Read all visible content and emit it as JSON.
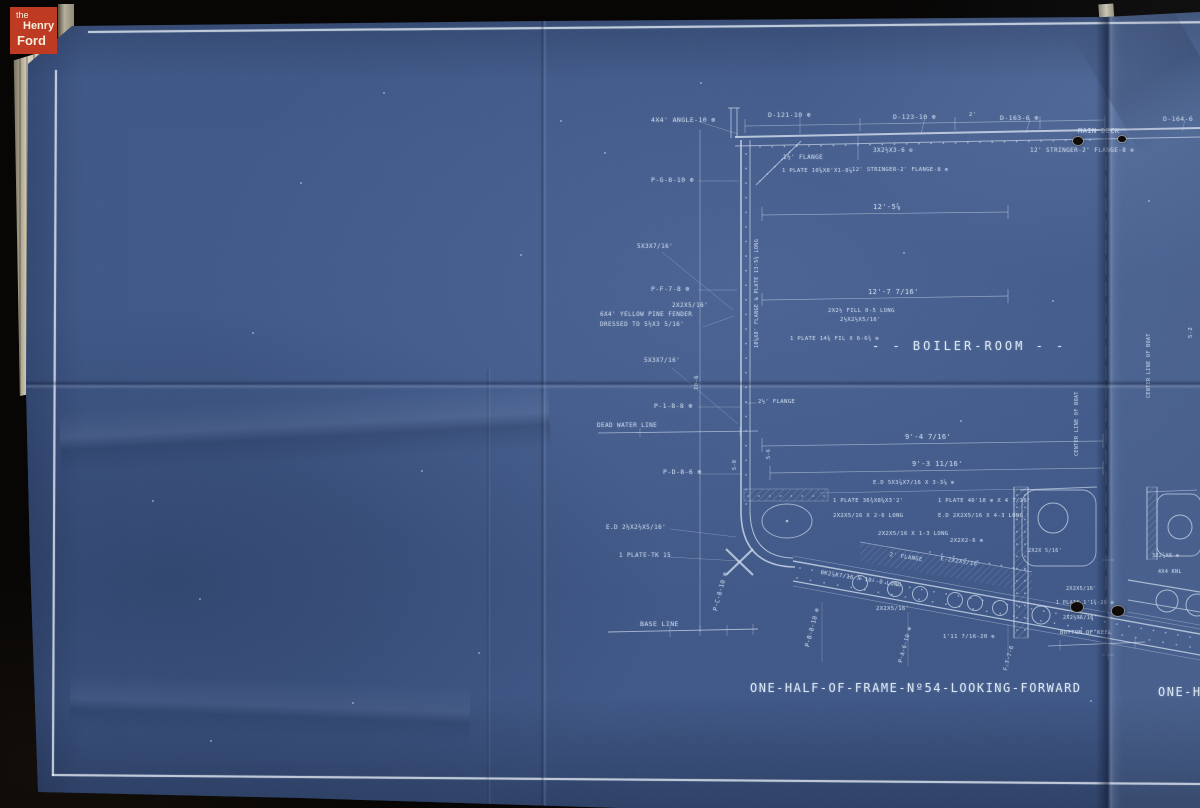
{
  "colors": {
    "paper_blue": "#3e5787",
    "line": "#cdd9ec",
    "logo_red": "#bf3a23",
    "backdrop": "#070605",
    "cream": "#d8d2bd"
  },
  "logo": {
    "prefix": "the",
    "top": "Henry",
    "bottom": "Ford"
  },
  "blueprint": {
    "room_label": "- - BOILER-ROOM - -",
    "caption": "ONE-HALF-OF-FRAME-Nº54-LOOKING-FORWARD",
    "caption_partial": "ONE-HA",
    "annotations": [
      {
        "t": "4X4' ANGLE-10 ⊕",
        "x": 651,
        "y": 116
      },
      {
        "t": "D-121-10 ⊕",
        "x": 768,
        "y": 111
      },
      {
        "t": "D-123-10 ⊕",
        "x": 893,
        "y": 113
      },
      {
        "t": "D-163-6 ⊕",
        "x": 1000,
        "y": 114
      },
      {
        "t": "D-164-6",
        "x": 1163,
        "y": 115
      },
      {
        "t": "MAIN DECK",
        "x": 1078,
        "y": 127,
        "s": 7
      },
      {
        "t": "12' STRINGER-2' FLANGE-8 ⊕",
        "x": 1030,
        "y": 147,
        "s": 6
      },
      {
        "t": "3X2½X3-6 ⊕",
        "x": 873,
        "y": 147,
        "s": 6
      },
      {
        "t": "1½' FLANGE",
        "x": 783,
        "y": 154,
        "s": 6
      },
      {
        "t": "1 PLATE 10⅝X8'X1-8⅞",
        "x": 782,
        "y": 168,
        "s": 5.5
      },
      {
        "t": "12' STRINGER-2' FLANGE-8 ⊕",
        "x": 852,
        "y": 167,
        "s": 5.5
      },
      {
        "t": "P-G-8-10 ⊕",
        "x": 651,
        "y": 176
      },
      {
        "t": "12'-5⅞",
        "x": 873,
        "y": 203,
        "s": 7
      },
      {
        "t": "5X3X7/16'",
        "x": 637,
        "y": 243,
        "s": 6
      },
      {
        "t": "P-F-7-8 ⊕",
        "x": 651,
        "y": 285
      },
      {
        "t": "2X2X5/16'",
        "x": 672,
        "y": 302,
        "s": 6
      },
      {
        "t": "12'-7 7/16'",
        "x": 868,
        "y": 288,
        "s": 7
      },
      {
        "t": "6X4' YELLOW PINE FENDER",
        "x": 600,
        "y": 311,
        "s": 6
      },
      {
        "t": "DRESSED TO 5½X3 5/16'",
        "x": 600,
        "y": 321,
        "s": 6
      },
      {
        "t": "2X2½ FILL 0-5 LONG",
        "x": 828,
        "y": 308,
        "s": 5.5
      },
      {
        "t": "2½X2½X5/16'",
        "x": 840,
        "y": 317,
        "s": 5.5
      },
      {
        "t": "1 PLATE 14⅜ FIL X 6-6¾ ⊕",
        "x": 790,
        "y": 336,
        "s": 5.5
      },
      {
        "t": "5X3X7/16'",
        "x": 644,
        "y": 357,
        "s": 6
      },
      {
        "t": "P-1-8-8 ⊕",
        "x": 654,
        "y": 402
      },
      {
        "t": "2½' FLANGE",
        "x": 758,
        "y": 399,
        "s": 5.5
      },
      {
        "t": "DEAD WATER LINE",
        "x": 597,
        "y": 422,
        "s": 6
      },
      {
        "t": "9'-4 7/16'",
        "x": 905,
        "y": 433,
        "s": 7
      },
      {
        "t": "9'-3 11/16'",
        "x": 912,
        "y": 460,
        "s": 7
      },
      {
        "t": "E.D 5X3⅞X7/16 X 3-3⅞ ⊕",
        "x": 873,
        "y": 480,
        "s": 5.5
      },
      {
        "t": "P-D-8-6 ⊕",
        "x": 663,
        "y": 468
      },
      {
        "t": "1 PLATE 36¾X8⅝X3'2'",
        "x": 833,
        "y": 498,
        "s": 5.5
      },
      {
        "t": "1 PLATE 46'18 ⊕ X 4 7/16'",
        "x": 938,
        "y": 498,
        "s": 5.5
      },
      {
        "t": "2X2X5/16 X 2-6 LONG",
        "x": 833,
        "y": 513,
        "s": 5.5
      },
      {
        "t": "E.D 2X2X5/16 X 4-3 LONG",
        "x": 938,
        "y": 513,
        "s": 5.5
      },
      {
        "t": "E.D 2½X2½X5/16'",
        "x": 606,
        "y": 524,
        "s": 6
      },
      {
        "t": "2X2X5/16 X 1-3 LONG",
        "x": 878,
        "y": 531,
        "s": 5.5
      },
      {
        "t": "2X2X2-6 ⊕",
        "x": 950,
        "y": 538,
        "s": 5.5
      },
      {
        "t": "1 PLATE-TK 15",
        "x": 619,
        "y": 552,
        "s": 6
      },
      {
        "t": "2' FLANGE",
        "x": 890,
        "y": 552,
        "r": 9,
        "s": 5.5
      },
      {
        "t": "E-2X2X5/16'",
        "x": 941,
        "y": 556,
        "r": 9,
        "s": 5.5
      },
      {
        "t": "6X2⅞X7/16 X 10'-0 LONG",
        "x": 821,
        "y": 570,
        "r": 9,
        "s": 5.5
      },
      {
        "t": "2X2X5/16'",
        "x": 876,
        "y": 606,
        "s": 5.5
      },
      {
        "t": "P-C-8-10 ⊕",
        "x": 712,
        "y": 610,
        "r": -75,
        "s": 6
      },
      {
        "t": "BASE LINE",
        "x": 640,
        "y": 620,
        "s": 6.5
      },
      {
        "t": "P-B-8-10 ⊕",
        "x": 804,
        "y": 646,
        "r": -75,
        "s": 6
      },
      {
        "t": "P-A-6-10 ⊕",
        "x": 898,
        "y": 662,
        "r": -75,
        "s": 5.5
      },
      {
        "t": "F-T-7-6",
        "x": 1003,
        "y": 670,
        "r": -75,
        "s": 5.5
      },
      {
        "t": "1'11 7/16-20 ⊕",
        "x": 943,
        "y": 634,
        "s": 5.5
      },
      {
        "t": "2X2X 5/16'",
        "x": 1028,
        "y": 548,
        "s": 5
      },
      {
        "t": "3X2⅞X6 ⊕",
        "x": 1152,
        "y": 553,
        "s": 5
      },
      {
        "t": "4X4 KNL",
        "x": 1158,
        "y": 569,
        "s": 5
      },
      {
        "t": "2X2X5/16'",
        "x": 1066,
        "y": 586,
        "s": 5
      },
      {
        "t": "1 PLATE 1'1¾-20 ⊕",
        "x": 1056,
        "y": 600,
        "s": 5
      },
      {
        "t": "2X2½X5/16'",
        "x": 1063,
        "y": 615,
        "s": 5
      },
      {
        "t": "BOTTOM OF KEEL",
        "x": 1060,
        "y": 630,
        "s": 5.5
      },
      {
        "t": "CENTER LINE OF BOAT",
        "x": 1146,
        "y": 398,
        "r": -90,
        "s": 5
      },
      {
        "t": "CENTER LINE OF BOAT",
        "x": 1074,
        "y": 456,
        "r": -90,
        "s": 5
      },
      {
        "t": "10⅝X8' FLANGE & PLATE 13-5¾ LONG",
        "x": 754,
        "y": 348,
        "r": -90,
        "s": 5
      },
      {
        "t": "10-6",
        "x": 694,
        "y": 390,
        "r": -90,
        "s": 5.5
      },
      {
        "t": "5-6",
        "x": 766,
        "y": 459,
        "r": -90,
        "s": 5
      },
      {
        "t": "5-0",
        "x": 732,
        "y": 470,
        "r": -90,
        "s": 5
      },
      {
        "t": "5-2",
        "x": 1188,
        "y": 338,
        "r": -90,
        "s": 5.5
      },
      {
        "t": "2'",
        "x": 969,
        "y": 112,
        "s": 5.5
      }
    ],
    "holes": [
      [
        1078,
        142,
        5
      ],
      [
        1122,
        140,
        4
      ],
      [
        1077,
        608,
        6
      ],
      [
        1118,
        612,
        6
      ]
    ],
    "specks": [
      [
        300,
        182
      ],
      [
        520,
        254
      ],
      [
        199,
        598
      ],
      [
        421,
        470
      ],
      [
        903,
        252
      ],
      [
        1052,
        300
      ],
      [
        352,
        702
      ],
      [
        152,
        500
      ],
      [
        604,
        152
      ],
      [
        252,
        332
      ],
      [
        478,
        652
      ],
      [
        1148,
        200
      ],
      [
        700,
        82
      ],
      [
        383,
        92
      ],
      [
        960,
        420
      ],
      [
        1090,
        700
      ],
      [
        210,
        740
      ],
      [
        560,
        120
      ]
    ],
    "drawing": {
      "lines": [
        [
          735,
          137,
          1200,
          128,
          2,
          0.85
        ],
        [
          735,
          146,
          1200,
          137,
          1,
          0.7
        ],
        [
          741,
          140,
          741,
          513,
          1.6,
          0.85
        ],
        [
          750,
          140,
          750,
          512,
          1,
          0.7
        ],
        [
          756,
          185,
          801,
          141,
          1,
          0.7
        ],
        [
          745,
          126,
          1105,
          120,
          0.7,
          0.55
        ],
        [
          745,
          119,
          745,
          133,
          0.7,
          0.55
        ],
        [
          860,
          118,
          860,
          131,
          0.7,
          0.55
        ],
        [
          955,
          117,
          955,
          130,
          0.7,
          0.55
        ],
        [
          1040,
          116,
          1040,
          129,
          0.7,
          0.55
        ],
        [
          1105,
          115,
          1105,
          128,
          0.7,
          0.55
        ],
        [
          800,
          116,
          800,
          134,
          0.6,
          0.5
        ],
        [
          925,
          118,
          921,
          134,
          0.6,
          0.5
        ],
        [
          1030,
          119,
          1026,
          133,
          0.6,
          0.5
        ],
        [
          1185,
          120,
          1182,
          131,
          0.6,
          0.5
        ],
        [
          762,
          215,
          1008,
          212,
          0.7,
          0.6
        ],
        [
          762,
          207,
          762,
          221,
          0.7,
          0.6
        ],
        [
          1008,
          205,
          1008,
          219,
          0.7,
          0.6
        ],
        [
          762,
          300,
          1008,
          296,
          0.7,
          0.6
        ],
        [
          762,
          293,
          762,
          306,
          0.7,
          0.6
        ],
        [
          1008,
          289,
          1008,
          303,
          0.7,
          0.6
        ],
        [
          762,
          446,
          1103,
          441,
          0.7,
          0.6
        ],
        [
          762,
          438,
          762,
          452,
          0.7,
          0.6
        ],
        [
          1103,
          434,
          1103,
          448,
          0.7,
          0.6
        ],
        [
          770,
          473,
          1103,
          468,
          0.7,
          0.6
        ],
        [
          770,
          466,
          770,
          480,
          0.7,
          0.6
        ],
        [
          1103,
          461,
          1103,
          475,
          0.7,
          0.6
        ],
        [
          820,
          493,
          1030,
          489,
          0.6,
          0.5
        ],
        [
          700,
          130,
          700,
          632,
          0.7,
          0.55
        ],
        [
          698,
          181,
          739,
          181,
          0.6,
          0.5
        ],
        [
          698,
          290,
          737,
          290,
          0.6,
          0.5
        ],
        [
          698,
          407,
          740,
          407,
          0.6,
          0.5
        ],
        [
          700,
          474,
          742,
          474,
          0.6,
          0.5
        ],
        [
          598,
          433,
          758,
          431,
          0.8,
          0.7
        ],
        [
          640,
          428,
          640,
          437,
          0.6,
          0.5
        ],
        [
          740,
          427,
          740,
          436,
          0.6,
          0.5
        ],
        [
          608,
          632,
          758,
          629,
          0.9,
          0.75
        ],
        [
          670,
          626,
          670,
          637,
          0.6,
          0.55
        ],
        [
          700,
          625,
          700,
          636,
          0.6,
          0.55
        ],
        [
          727,
          625,
          727,
          636,
          0.6,
          0.55
        ],
        [
          753,
          624,
          753,
          635,
          0.6,
          0.55
        ],
        [
          793,
          561,
          1200,
          634,
          1.4,
          0.8
        ],
        [
          793,
          556,
          1200,
          629,
          0.6,
          0.5
        ],
        [
          793,
          581,
          1200,
          655,
          1.2,
          0.8
        ],
        [
          793,
          586,
          1200,
          660,
          0.6,
          0.5
        ],
        [
          860,
          542,
          1032,
          572,
          0.8,
          0.6
        ],
        [
          1014,
          487,
          1014,
          638,
          1,
          0.75
        ],
        [
          1028,
          487,
          1028,
          638,
          1,
          0.7
        ],
        [
          1020,
          490,
          1097,
          487,
          0.9,
          0.7
        ],
        [
          858,
          135,
          858,
          160,
          0.7,
          0.5
        ],
        [
          731,
          108,
          731,
          138,
          1,
          0.7
        ],
        [
          737,
          108,
          737,
          138,
          1,
          0.7
        ],
        [
          728,
          108,
          740,
          108,
          1,
          0.7
        ],
        [
          1108,
          556,
          1108,
          660,
          0.6,
          0.5
        ],
        [
          1102,
          560,
          1114,
          560,
          0.6,
          0.5
        ],
        [
          1102,
          655,
          1114,
          655,
          0.6,
          0.5
        ],
        [
          1048,
          646,
          1145,
          642,
          0.8,
          0.7
        ],
        [
          1060,
          640,
          1060,
          650,
          0.6,
          0.5
        ],
        [
          1135,
          638,
          1135,
          648,
          0.6,
          0.5
        ],
        [
          1128,
          580,
          1200,
          592,
          1.2,
          0.75
        ],
        [
          1128,
          600,
          1200,
          612,
          1.1,
          0.7
        ],
        [
          1128,
          612,
          1200,
          625,
          0.6,
          0.5
        ],
        [
          1147,
          487,
          1147,
          560,
          1,
          0.7
        ],
        [
          1157,
          487,
          1157,
          560,
          0.9,
          0.65
        ],
        [
          1147,
          492,
          1197,
          490,
          0.8,
          0.6
        ],
        [
          662,
          252,
          733,
          310,
          0.5,
          0.45
        ],
        [
          672,
          368,
          738,
          424,
          0.5,
          0.45
        ],
        [
          700,
          122,
          738,
          134,
          0.5,
          0.5
        ],
        [
          703,
          327,
          734,
          316,
          0.5,
          0.45
        ],
        [
          668,
          557,
          740,
          561,
          0.5,
          0.45
        ],
        [
          670,
          529,
          736,
          537,
          0.5,
          0.45
        ],
        [
          822,
          602,
          822,
          662,
          0.5,
          0.45
        ],
        [
          908,
          612,
          908,
          666,
          0.5,
          0.45
        ],
        [
          1008,
          624,
          1008,
          668,
          0.5,
          0.45
        ],
        [
          745,
          403,
          756,
          403,
          0.6,
          0.5
        ]
      ],
      "dashes": [
        [
          1106,
          135,
          1106,
          660
        ]
      ],
      "paths": [
        {
          "d": "M741,513 Q742,566 795,567",
          "w": 1.6
        },
        {
          "d": "M750,512 Q751,557 793,558",
          "w": 1
        },
        {
          "d": "M726,549 L753,575",
          "w": 2.2
        },
        {
          "d": "M753,549 L726,575",
          "w": 2.2
        }
      ],
      "circles": [
        [
          860,
          583,
          7.5
        ],
        [
          895,
          589,
          7.5
        ],
        [
          920,
          594,
          7.5
        ],
        [
          955,
          600,
          7.5
        ],
        [
          975,
          603,
          7.5
        ],
        [
          1000,
          608,
          7.5
        ],
        [
          1041,
          615,
          9
        ],
        [
          1053,
          518,
          15
        ],
        [
          1180,
          527,
          12
        ],
        [
          1167,
          601,
          11
        ],
        [
          1197,
          605,
          11
        ]
      ],
      "ellipses": [
        [
          787,
          521,
          25,
          17
        ]
      ],
      "dots_center": [
        [
          787,
          521,
          1.3
        ]
      ],
      "rects": [
        {
          "x": 1022,
          "y": 490,
          "w": 74,
          "h": 76,
          "rx": 14
        },
        {
          "x": 1157,
          "y": 494,
          "w": 44,
          "h": 62,
          "rx": 10
        }
      ],
      "hatch_rects": [
        [
          744,
          489,
          84,
          12
        ],
        [
          1014,
          487,
          14,
          151
        ],
        [
          1147,
          487,
          10,
          72
        ]
      ],
      "hatch_poly": "860,542 1032,572 1032,592 860,562",
      "dot_rows": [
        [
          760,
          147,
          1090,
          140,
          28
        ],
        [
          746,
          154,
          746,
          504,
          25
        ],
        [
          760,
          181,
          797,
          145,
          6
        ],
        [
          800,
          568,
          1190,
          637,
          33
        ],
        [
          797,
          578,
          1190,
          647,
          30
        ],
        [
          748,
          496,
          824,
          496,
          8
        ],
        [
          930,
          552,
          1025,
          570,
          9
        ],
        [
          1017,
          495,
          1017,
          630,
          12
        ],
        [
          1025,
          495,
          1025,
          630,
          12
        ]
      ]
    }
  }
}
